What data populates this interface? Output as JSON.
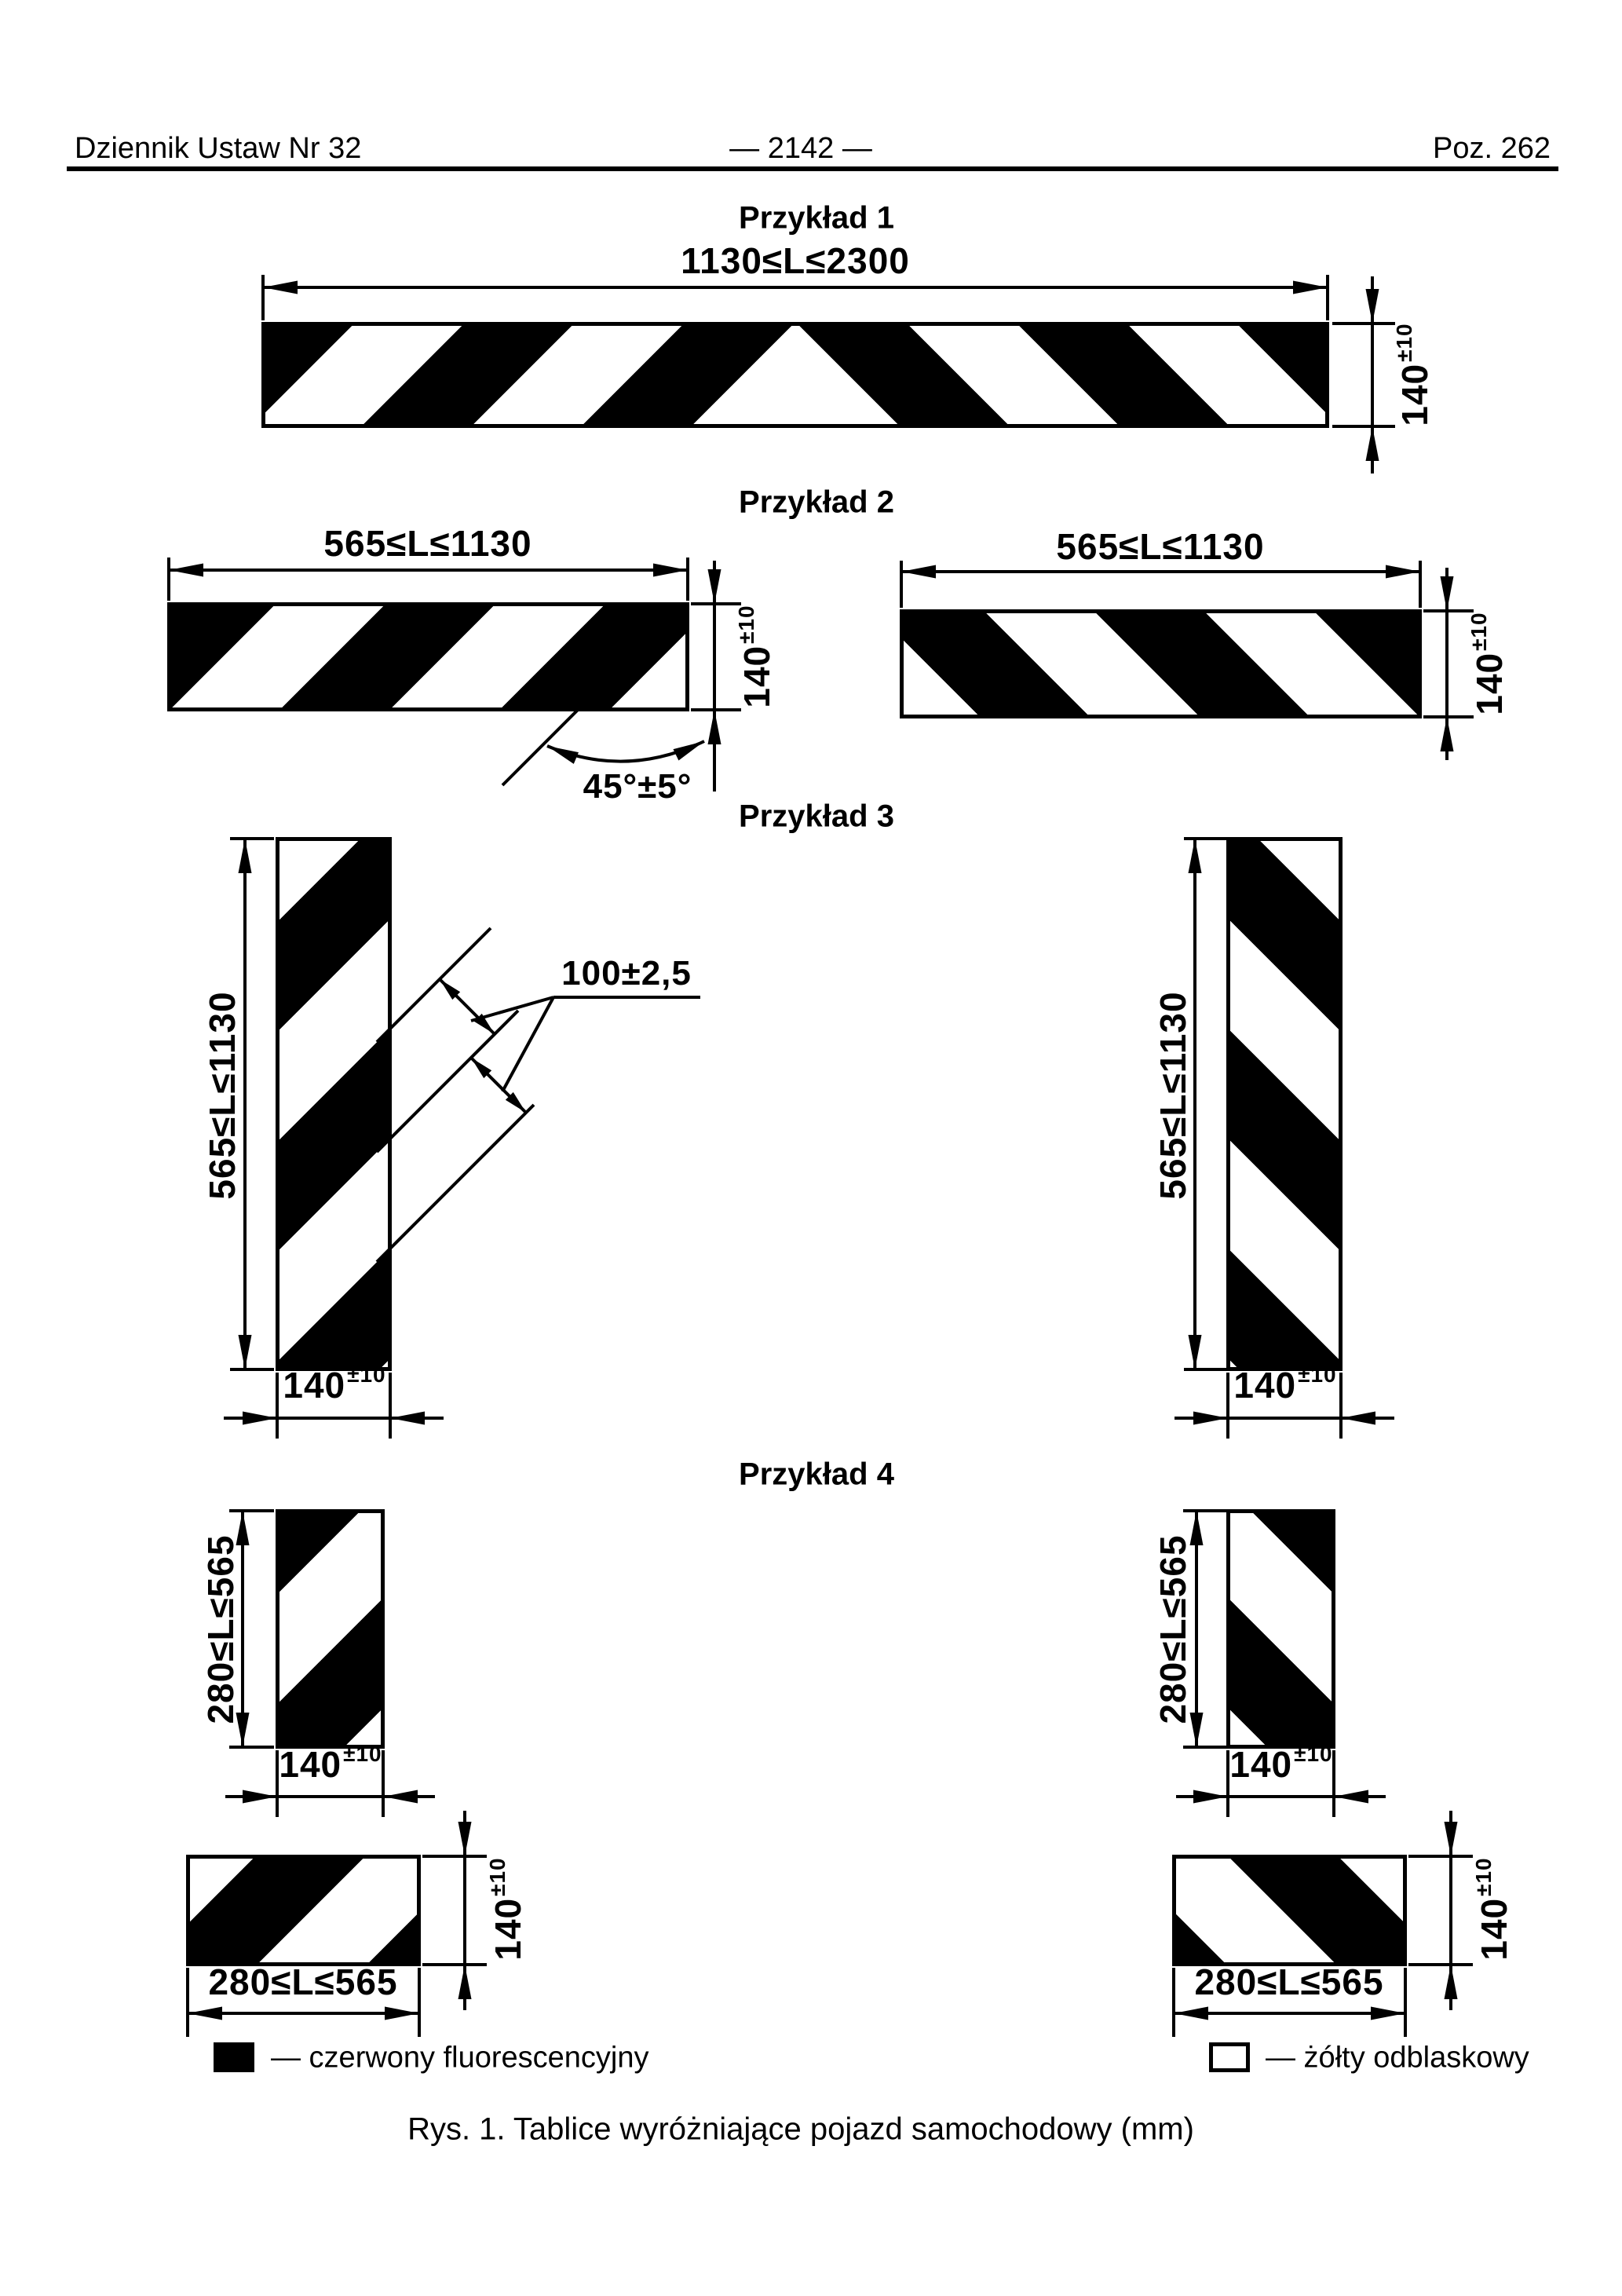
{
  "header": {
    "left": "Dziennik Ustaw Nr 32",
    "center": "— 2142 —",
    "right": "Poz. 262"
  },
  "figure": {
    "example1": {
      "title": "Przykład 1",
      "length_label": "1130≤L≤2300",
      "height": {
        "value": "140",
        "tol": "±10"
      }
    },
    "example2": {
      "title": "Przykład 2",
      "length_label": "565≤L≤1130",
      "height": {
        "value": "140",
        "tol": "±10"
      },
      "angle_label": "45°±5°"
    },
    "example3": {
      "title": "Przykład 3",
      "length_label": "565≤L≤1130",
      "stripe_width_label": "100±2,5",
      "width": {
        "value": "140",
        "tol": "±10"
      }
    },
    "example4": {
      "title": "Przykład 4",
      "side_label": "280≤L≤565",
      "length_label": "280≤L≤565",
      "width": {
        "value": "140",
        "tol": "±10"
      }
    }
  },
  "legend": {
    "red_label": "— czerwony fluorescencyjny",
    "yellow_label": "— żółty odblaskowy"
  },
  "caption": "Rys. 1. Tablice wyróżniające pojazd samochodowy (mm)",
  "colors": {
    "ink": "#000000",
    "paper": "#ffffff"
  }
}
